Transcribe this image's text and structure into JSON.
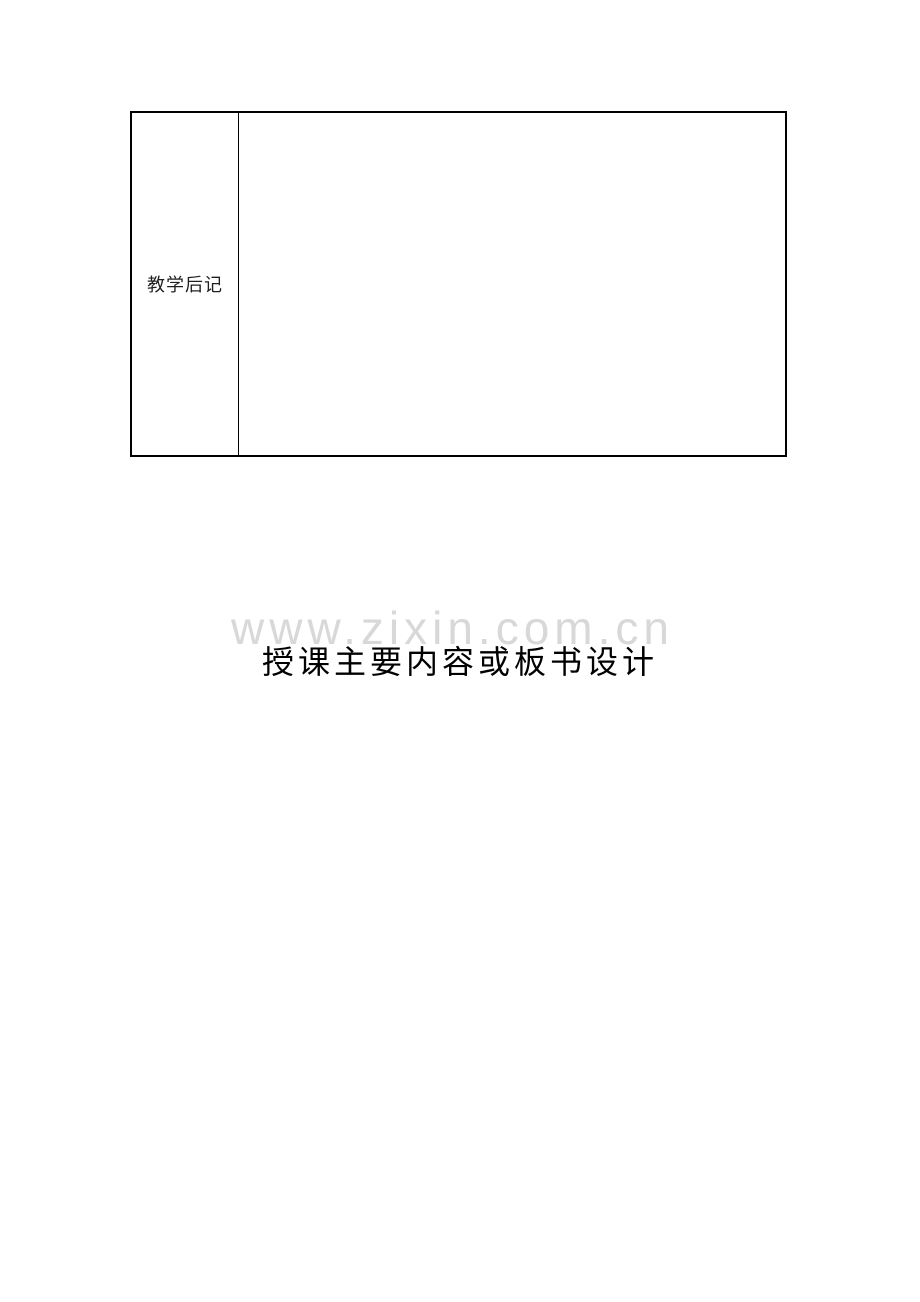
{
  "document": {
    "table": {
      "label": "教学后记"
    },
    "watermark": {
      "text": "www.zixin.com.cn",
      "color": "#d8d8d8"
    },
    "heading": {
      "text": "授课主要内容或板书设计"
    },
    "colors": {
      "table_border": "#000000",
      "page_background": "#ffffff"
    }
  }
}
